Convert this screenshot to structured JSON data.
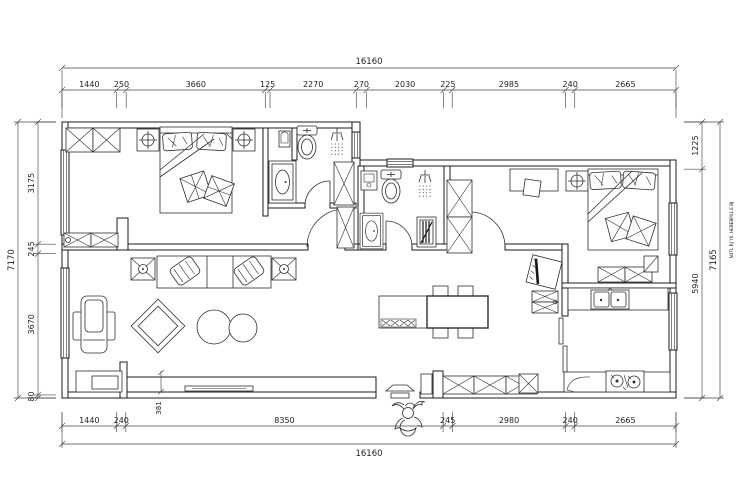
{
  "drawing": {
    "type": "floor-plan",
    "units": "mm"
  },
  "dimensions": {
    "top": {
      "total": "16160",
      "segments": [
        "1440",
        "250",
        "3660",
        "125",
        "2270",
        "270",
        "2030",
        "225",
        "2985",
        "240",
        "2665"
      ]
    },
    "bottom": {
      "total": "16160",
      "segments": [
        "1440",
        "240",
        "8350",
        "245",
        "2980",
        "240",
        "2665"
      ]
    },
    "left": {
      "total": "7170",
      "segments": [
        "3175",
        "245",
        "3670",
        "80"
      ]
    },
    "right": {
      "total": "7165",
      "segments": [
        "1225",
        "5940"
      ]
    },
    "inline": {
      "tv_ledge": "381"
    }
  },
  "watermark": "N4TL RJ Y6. HEBEBPXL E BJ",
  "colors": {
    "line": "#1b1b1b",
    "dim": "#444444",
    "background": "#ffffff"
  }
}
